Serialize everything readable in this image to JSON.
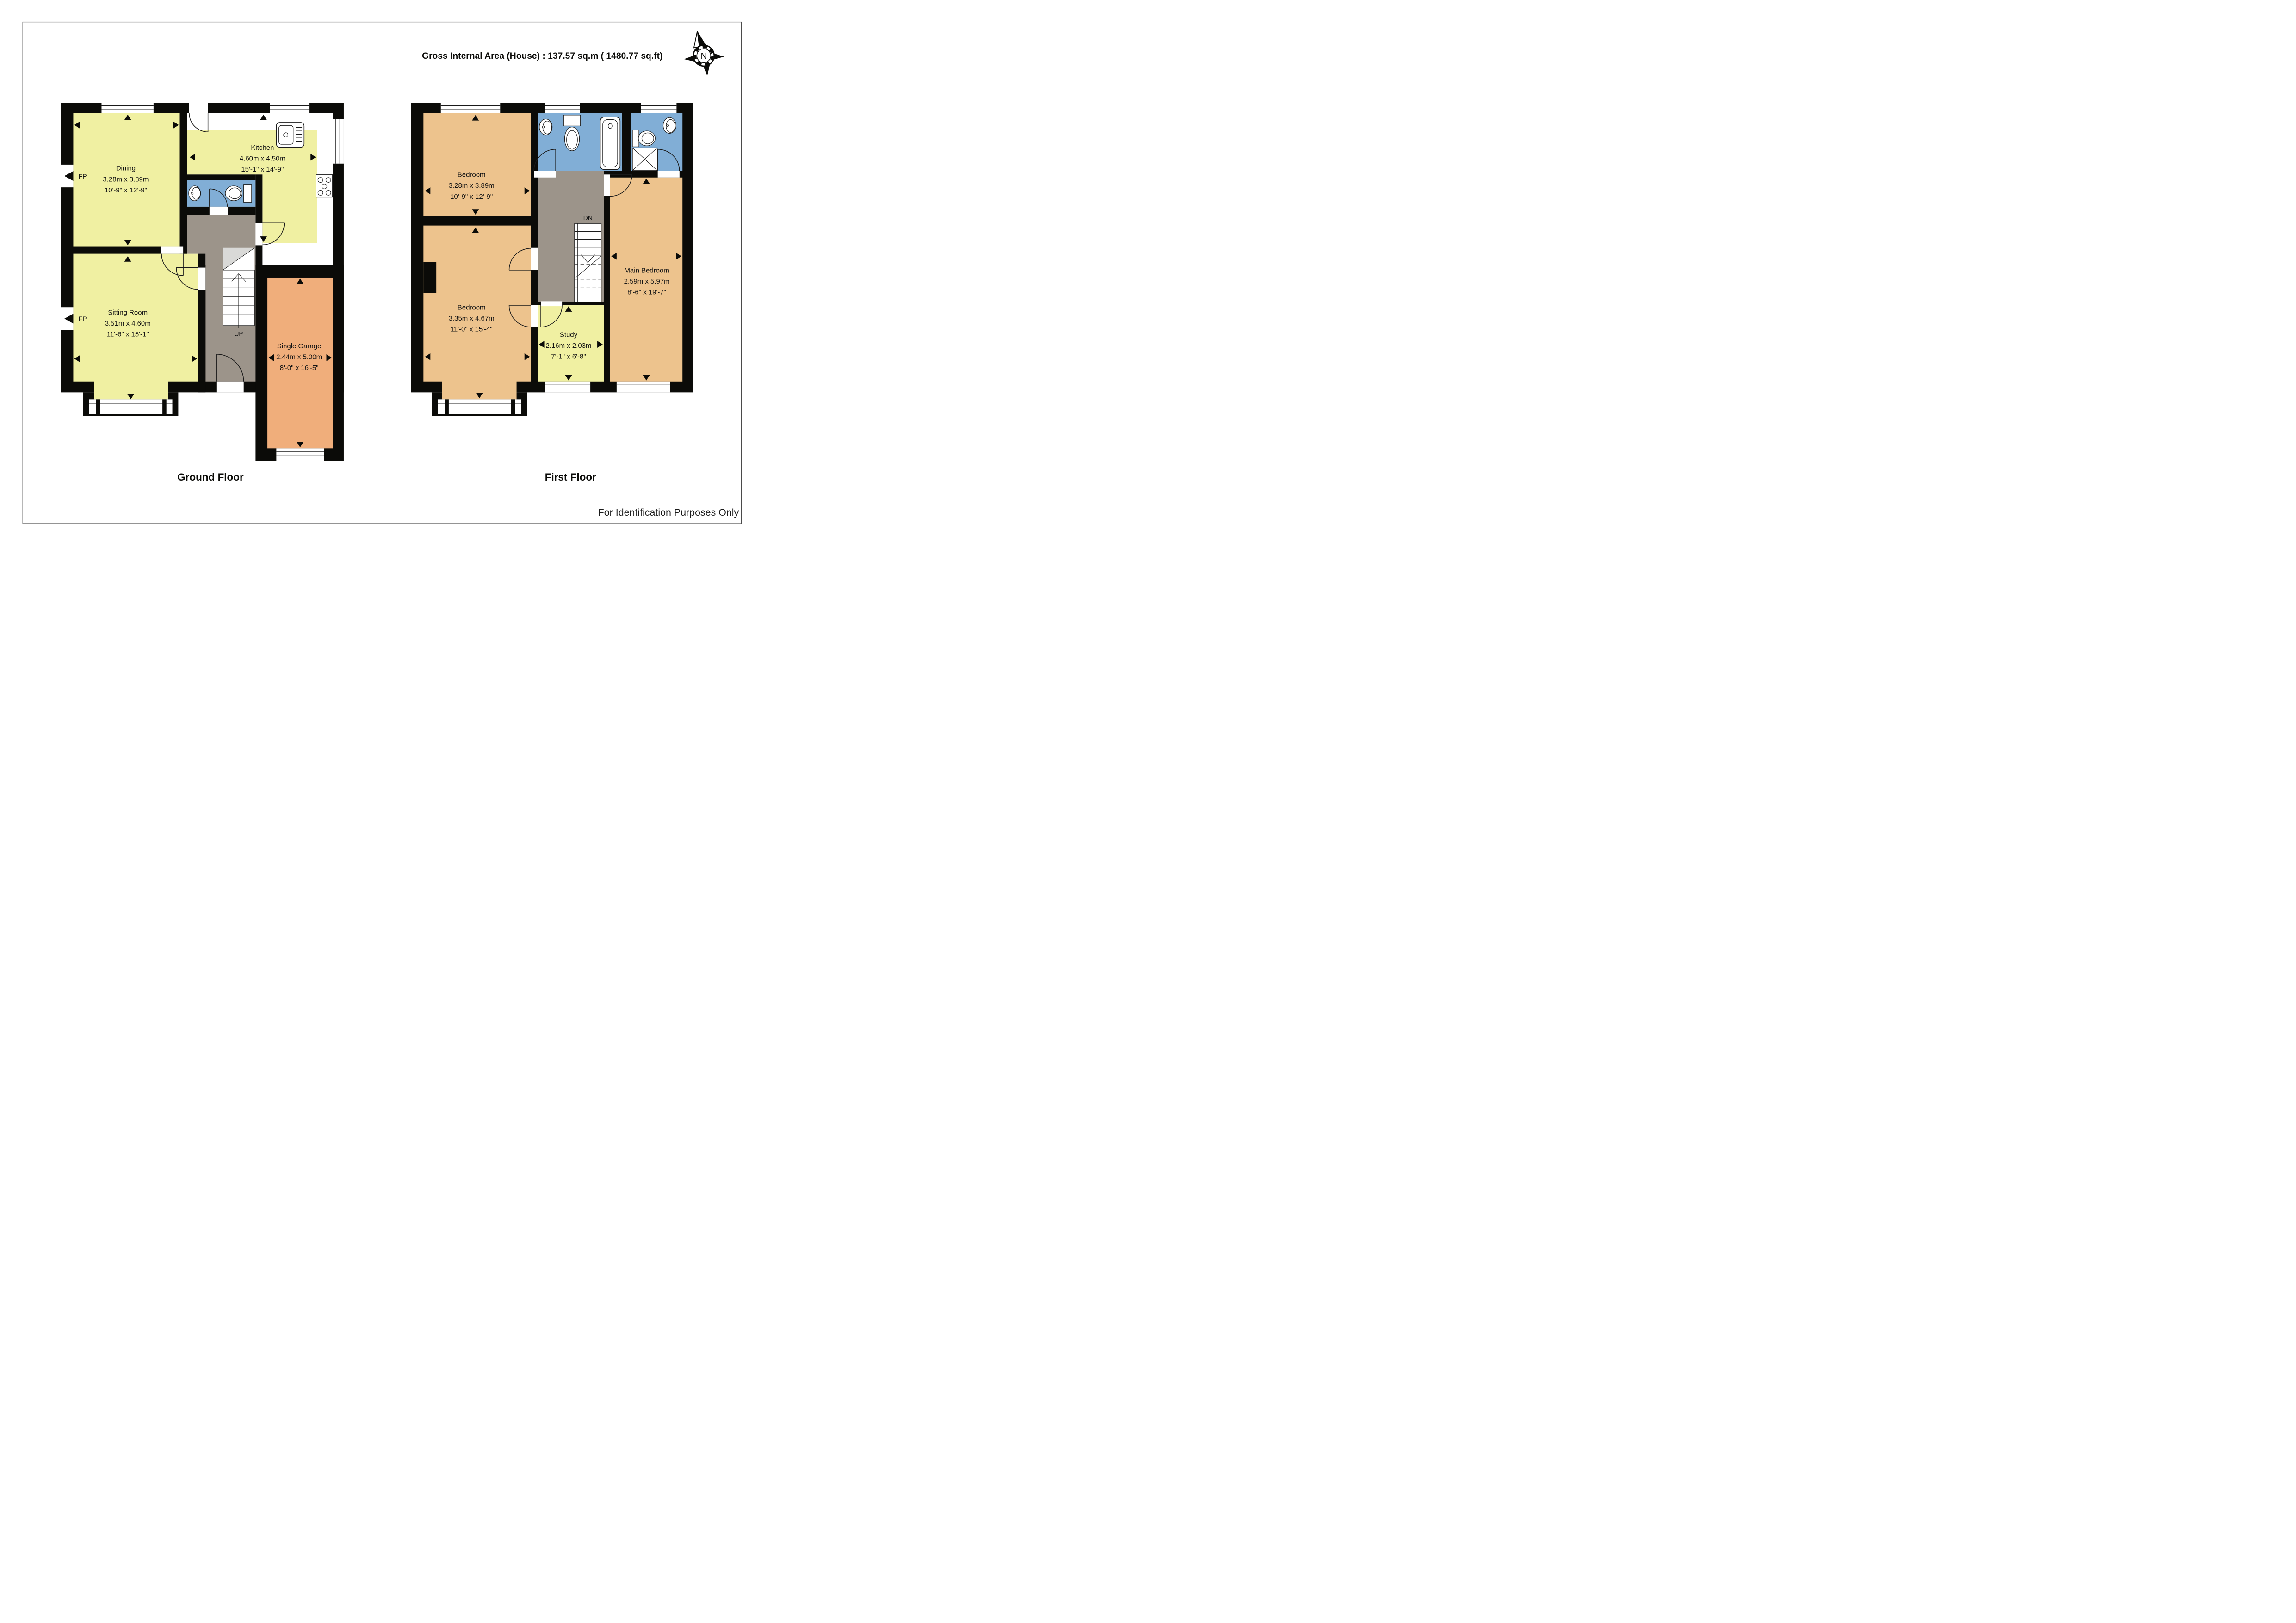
{
  "page": {
    "header": "Gross Internal Area (House) : 137.57 sq.m ( 1480.77 sq.ft)",
    "footer": "For Identification Purposes Only",
    "compass_label": "N"
  },
  "labels": {
    "up": "UP",
    "dn": "DN",
    "fp": "FP"
  },
  "floors": {
    "ground": {
      "title": "Ground Floor",
      "rooms": {
        "dining": {
          "name": "Dining",
          "metric": "3.28m x 3.89m",
          "imperial": "10'-9\" x 12'-9\""
        },
        "kitchen": {
          "name": "Kitchen",
          "metric": "4.60m x 4.50m",
          "imperial": "15'-1\" x 14'-9\""
        },
        "sitting": {
          "name": "Sitting Room",
          "metric": "3.51m x 4.60m",
          "imperial": "11'-6\" x 15'-1\""
        },
        "garage": {
          "name": "Single Garage",
          "metric": "2.44m x 5.00m",
          "imperial": "8'-0\" x 16'-5\""
        }
      }
    },
    "first": {
      "title": "First Floor",
      "rooms": {
        "bedroom1": {
          "name": "Bedroom",
          "metric": "3.28m x 3.89m",
          "imperial": "10'-9\" x 12'-9\""
        },
        "bedroom2": {
          "name": "Bedroom",
          "metric": "3.35m x 4.67m",
          "imperial": "11'-0\" x 15'-4\""
        },
        "main_bedroom": {
          "name": "Main Bedroom",
          "metric": "2.59m x 5.97m",
          "imperial": "8'-6\" x 19'-7\""
        },
        "study": {
          "name": "Study",
          "metric": "2.16m x 2.03m",
          "imperial": "7'-1\" x 6'-8\""
        }
      }
    }
  },
  "colors": {
    "room_yellow": "#f0f0a2",
    "room_tan": "#edc38d",
    "garage_orange": "#f0ae7b",
    "bathroom_blue": "#81aed6",
    "hall_grey": "#9c948a",
    "understair_grey": "#d9d9d7",
    "wall_black": "#0b0b08"
  }
}
